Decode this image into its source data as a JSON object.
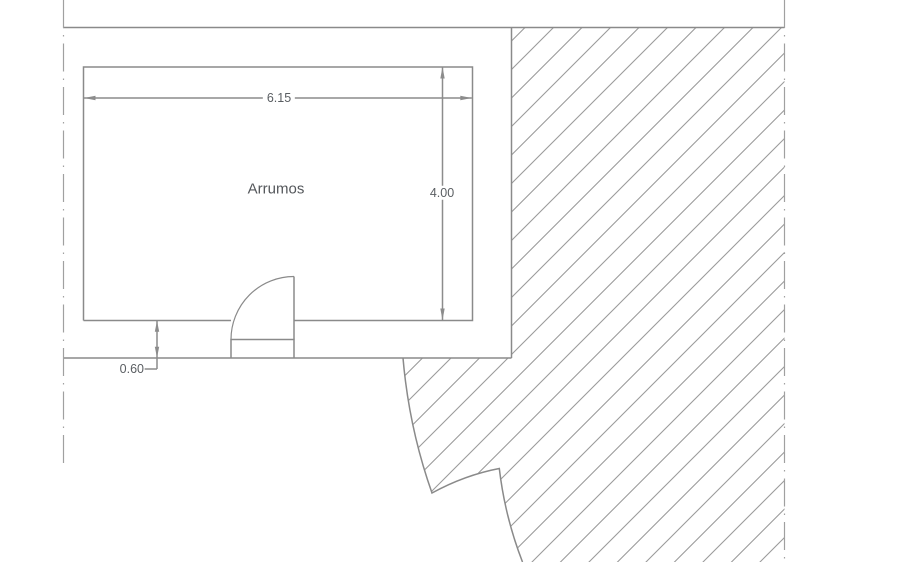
{
  "floor_plan": {
    "room_label": "Arrumos",
    "dimensions": {
      "width_m": "6.15",
      "depth_m": "4.00",
      "wall_offset_m": "0.60"
    },
    "colors": {
      "background": "#ffffff",
      "outline_line": "#8a8a8a",
      "hatch_line": "#9b9b9b",
      "dimension_line": "#8c8c8c",
      "room_label_text": "#54575b",
      "dimension_text": "#5a5e62",
      "centerline": "#a0a0a0"
    }
  }
}
